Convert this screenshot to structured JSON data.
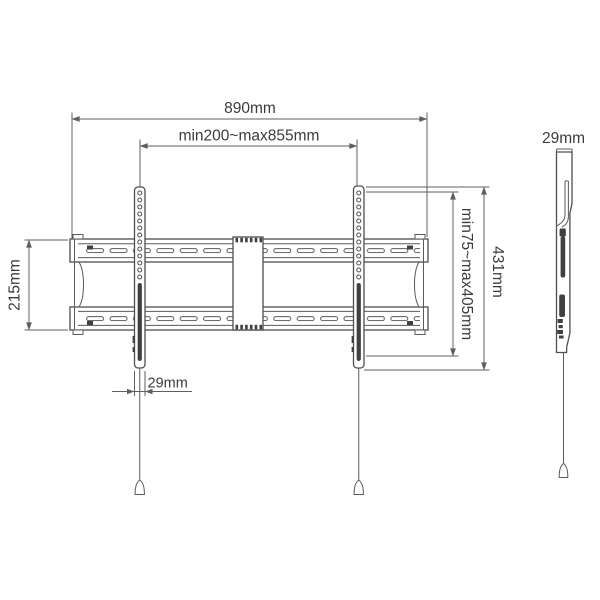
{
  "front_view": {
    "overall_width": "890mm",
    "tv_rail_spacing": "min200~max855mm",
    "wall_plate_height": "215mm",
    "rail_length": "431mm",
    "vesa_height_range": "min75~max405mm",
    "rail_width": "29mm"
  },
  "side_view": {
    "depth": "29mm"
  },
  "colors": {
    "line": "#4f4f4f",
    "dimension_line": "#5f5f5f",
    "text": "#3b3b3b",
    "dark_fill": "#404040",
    "background": "#ffffff"
  }
}
